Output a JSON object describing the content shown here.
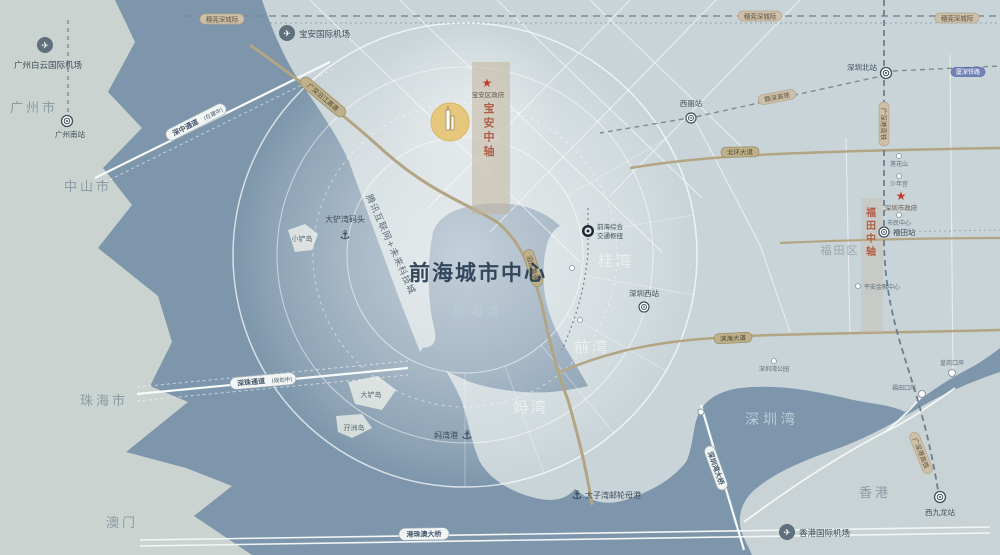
{
  "map": {
    "title": "前海城市中心",
    "colors": {
      "water": "#7d96ab",
      "west_land": "#cbd3d0",
      "shenzhen_land": "#c9d4d8",
      "axis_red": "#b0604a",
      "highlight_yellow": "#e6c77e",
      "star_red": "#bf3b2b",
      "expressway_tan": "#b3a583"
    },
    "regions": {
      "guangzhou": "广州市",
      "zhongshan": "中山市",
      "zhuhai": "珠海市",
      "macau": "澳门",
      "hongkong": "香港",
      "futian": "福田区"
    },
    "waters": {
      "qianhai_bay": "前海湾",
      "shenzhen_bay": "深圳湾"
    },
    "districts": {
      "guiwan": "桂湾",
      "qianwan": "前湾",
      "mawan": "妈湾"
    },
    "axes": {
      "baoan": "宝安中轴",
      "futian": "福田中轴"
    },
    "airports": {
      "baiyun": "广州白云国际机场",
      "baoan": "宝安国际机场",
      "hongkong": "香港国际机场"
    },
    "stations": {
      "guangzhou_south": "广州南站",
      "shenzhen_north": "深圳北站",
      "xili": "西丽站",
      "futian": "福田站",
      "shenzhen_west": "深圳西站",
      "west_kowloon": "西九龙站",
      "qianhai_hub_line1": "前海综合",
      "qianhai_hub_line2": "交通枢纽"
    },
    "checkpoints": {
      "futian_port": "福田口岸",
      "huanggang_port": "皇岗口岸"
    },
    "ports": {
      "dachanwan": "大铲湾码头",
      "mawan_port": "妈湾港",
      "prince_bay": "太子湾邮轮母港"
    },
    "islands": {
      "xiaochan": "小铲岛",
      "dachan": "大铲岛",
      "mazhou": "孖洲岛"
    },
    "government": {
      "baoan": "宝安区政府",
      "shenzhen": "深圳市政府"
    },
    "pois": {
      "tencent": "腾讯互联网+未来科技城",
      "szbay_park": "深圳湾公园",
      "lianhuashan": "莲花山",
      "children_palace": "少年宫",
      "civic_center": "市民中心",
      "pingan": "平安金融中心"
    },
    "roads": {
      "shenzhong": "深中通道",
      "shenzhong_note": "(在建中)",
      "shenzhu": "深珠通道",
      "shenzhu_note": "(规划中)",
      "yanjiang_expwy": "广深沿江高速",
      "yanjiang_short": "沿江高速",
      "hzm_bridge": "港珠澳大桥",
      "szbay_bridge": "深圳湾大桥",
      "binhai_blvd": "滨海大道",
      "beihuan_blvd": "北环大道"
    },
    "rails": {
      "suiwanshen": "穗莞深城际",
      "gsg_hsr": "广深港高铁",
      "ganshen_hsr": "赣深高铁",
      "xiashen_rail": "厦深铁路"
    }
  }
}
